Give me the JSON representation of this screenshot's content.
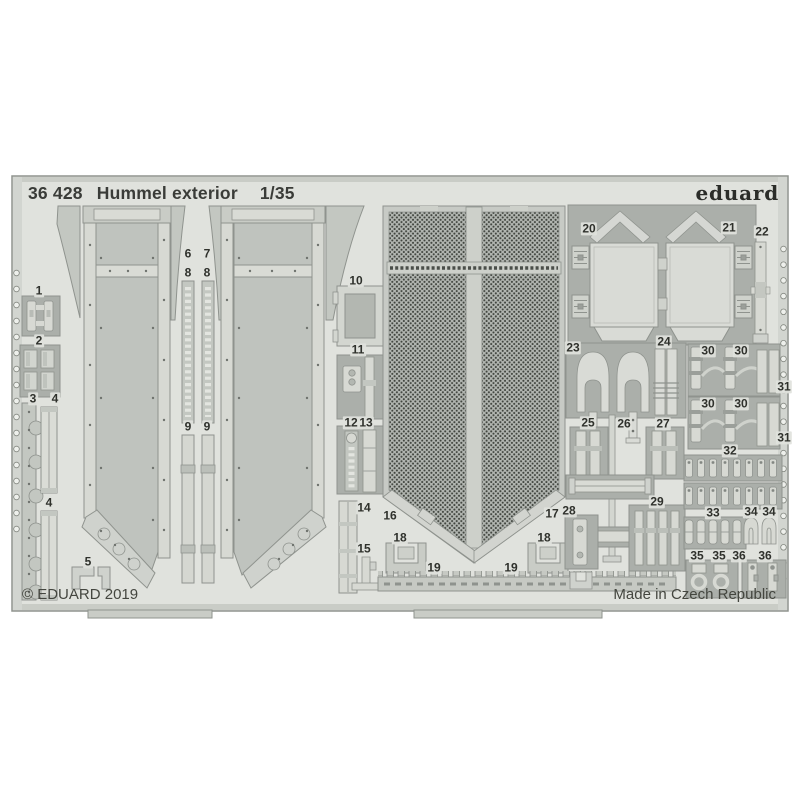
{
  "header": {
    "catalog_number": "36 428",
    "product_name": "Hummel exterior",
    "scale": "1/35",
    "brand": "eduard"
  },
  "footer": {
    "copyright": "© EDUARD 2019",
    "made_in": "Made in Czech Republic"
  },
  "colors": {
    "sheet_background": "#e0e2dd",
    "metal_light": "#d7d9d3",
    "metal_mid": "#c3c7c1",
    "metal_dark": "#abafaa",
    "mesh_dot": "#41453f",
    "text": "#33352f"
  },
  "part_labels": [
    {
      "n": "1",
      "x": 39,
      "y": 291
    },
    {
      "n": "2",
      "x": 39,
      "y": 341
    },
    {
      "n": "3",
      "x": 33,
      "y": 399
    },
    {
      "n": "4",
      "x": 55,
      "y": 399
    },
    {
      "n": "4",
      "x": 49,
      "y": 503
    },
    {
      "n": "5",
      "x": 88,
      "y": 562
    },
    {
      "n": "6",
      "x": 188,
      "y": 254
    },
    {
      "n": "7",
      "x": 207,
      "y": 254
    },
    {
      "n": "8",
      "x": 188,
      "y": 273
    },
    {
      "n": "8",
      "x": 207,
      "y": 273
    },
    {
      "n": "9",
      "x": 188,
      "y": 427
    },
    {
      "n": "9",
      "x": 207,
      "y": 427
    },
    {
      "n": "10",
      "x": 356,
      "y": 281
    },
    {
      "n": "11",
      "x": 358,
      "y": 350
    },
    {
      "n": "12",
      "x": 351,
      "y": 423
    },
    {
      "n": "13",
      "x": 366,
      "y": 423
    },
    {
      "n": "14",
      "x": 364,
      "y": 508
    },
    {
      "n": "15",
      "x": 364,
      "y": 549
    },
    {
      "n": "16",
      "x": 390,
      "y": 516
    },
    {
      "n": "17",
      "x": 552,
      "y": 514
    },
    {
      "n": "18",
      "x": 400,
      "y": 538
    },
    {
      "n": "18",
      "x": 544,
      "y": 538
    },
    {
      "n": "19",
      "x": 434,
      "y": 568
    },
    {
      "n": "19",
      "x": 511,
      "y": 568
    },
    {
      "n": "20",
      "x": 589,
      "y": 229
    },
    {
      "n": "21",
      "x": 729,
      "y": 228
    },
    {
      "n": "22",
      "x": 762,
      "y": 232
    },
    {
      "n": "23",
      "x": 573,
      "y": 348
    },
    {
      "n": "24",
      "x": 664,
      "y": 342
    },
    {
      "n": "25",
      "x": 588,
      "y": 423
    },
    {
      "n": "26",
      "x": 624,
      "y": 424
    },
    {
      "n": "27",
      "x": 663,
      "y": 424
    },
    {
      "n": "28",
      "x": 569,
      "y": 511
    },
    {
      "n": "29",
      "x": 657,
      "y": 502
    },
    {
      "n": "30",
      "x": 708,
      "y": 351
    },
    {
      "n": "30",
      "x": 741,
      "y": 351
    },
    {
      "n": "30",
      "x": 708,
      "y": 404
    },
    {
      "n": "30",
      "x": 741,
      "y": 404
    },
    {
      "n": "31",
      "x": 784,
      "y": 387
    },
    {
      "n": "31",
      "x": 784,
      "y": 438
    },
    {
      "n": "32",
      "x": 730,
      "y": 451
    },
    {
      "n": "33",
      "x": 713,
      "y": 513
    },
    {
      "n": "34",
      "x": 751,
      "y": 512
    },
    {
      "n": "34",
      "x": 769,
      "y": 512
    },
    {
      "n": "35",
      "x": 697,
      "y": 556
    },
    {
      "n": "35",
      "x": 719,
      "y": 556
    },
    {
      "n": "36",
      "x": 739,
      "y": 556
    },
    {
      "n": "36",
      "x": 765,
      "y": 556
    }
  ]
}
